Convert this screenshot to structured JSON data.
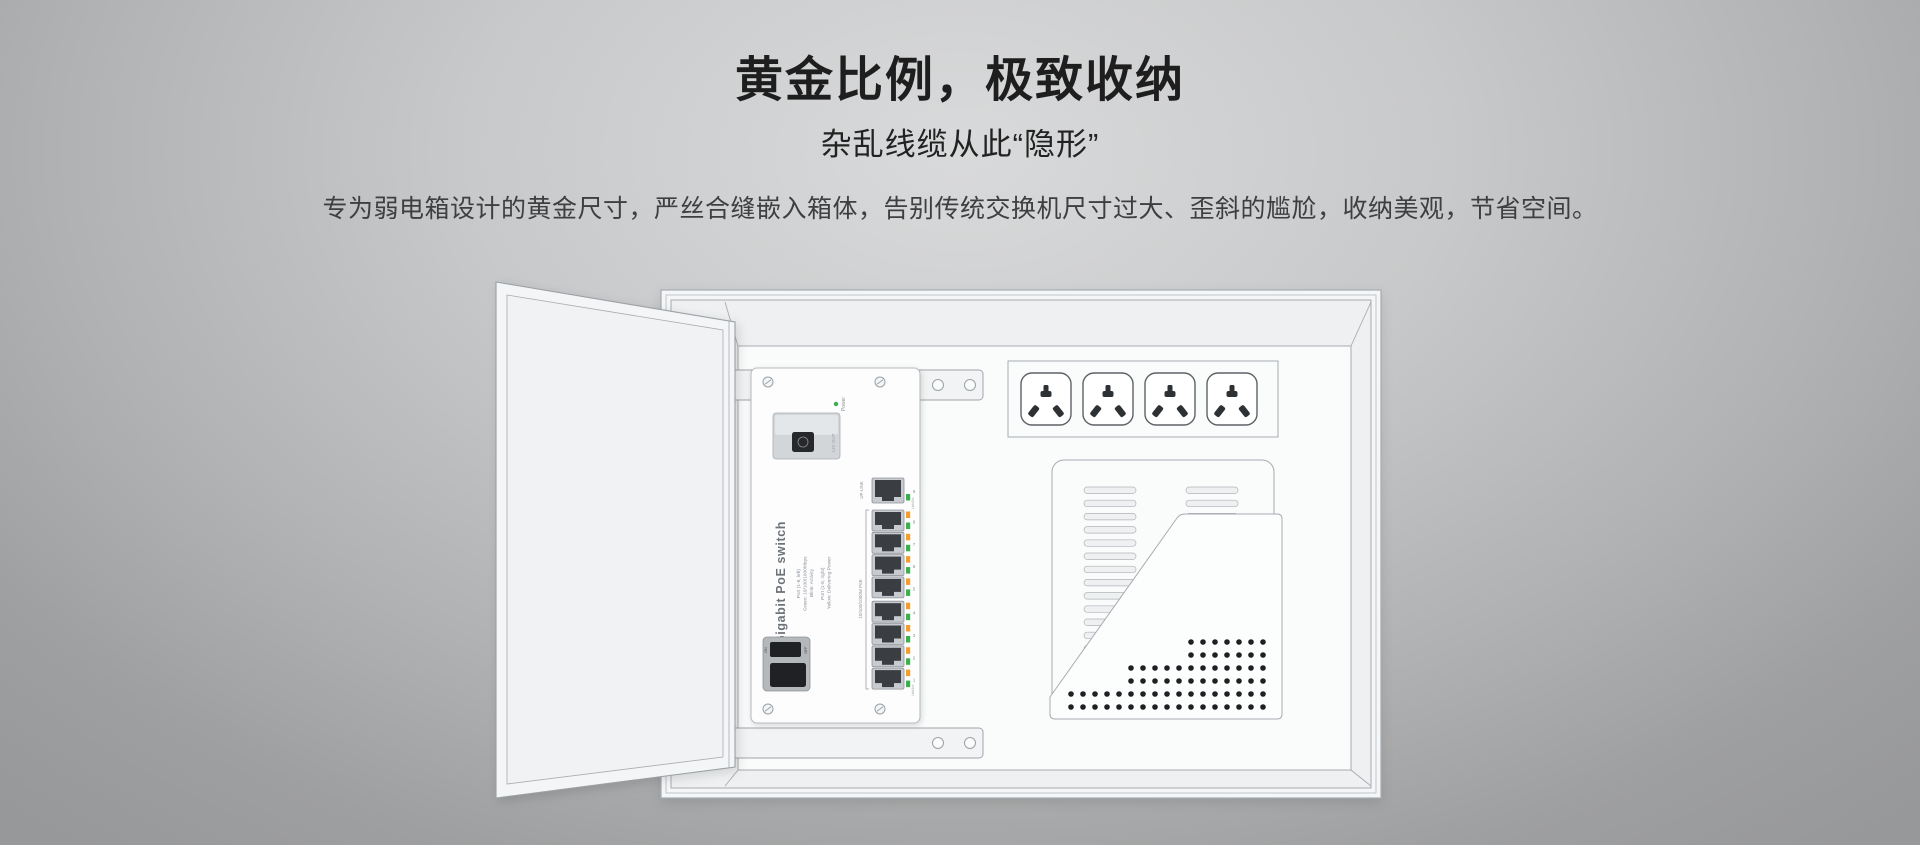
{
  "page": {
    "title": "黄金比例，极致收纳",
    "subtitle": "杂乱线缆从此“隐形”",
    "description": "专为弱电箱设计的黄金尺寸，严丝合缝嵌入箱体，告别传统交换机尺寸过大、歪斜的尴尬，收纳美观，节省空间。"
  },
  "colors": {
    "background_center": "#d9dadb",
    "background_edge": "#97989a",
    "heading_text": "#1e1e1e",
    "body_text": "#3e3f40",
    "line": "#a7acb1",
    "panel_fill": "#f7f8f9",
    "cavity_fill": "#fafbfb",
    "jack_dark": "#3a3e42",
    "led_green": "#3cae4e",
    "led_orange": "#f39c2f",
    "dot_black": "#1e2023"
  },
  "illustration": {
    "alt": "weak-current distribution box with open door, embedded gigabit PoE switch, power outlets and vented panel",
    "switch": {
      "title": "Gigabit PoE switch",
      "legend_left": [
        "Port (1-8, left)",
        "Green: 10/100/1000Mbps",
        "Blink: Activity"
      ],
      "legend_right": [
        "Port (1-8, right)",
        "Yellow: Delivering Power"
      ],
      "power_label": "Power",
      "dc_out_label": "12V OUT",
      "dip_on_label": "ON",
      "dip_off_label": "OFF",
      "uplink_label": "UP-LINK",
      "ports_group_label": "10/100/1000M PoE",
      "link_act_label": "Link/Act",
      "port_numbers": [
        "9",
        "8",
        "7",
        "6",
        "5",
        "4",
        "3",
        "2",
        "1"
      ]
    }
  }
}
